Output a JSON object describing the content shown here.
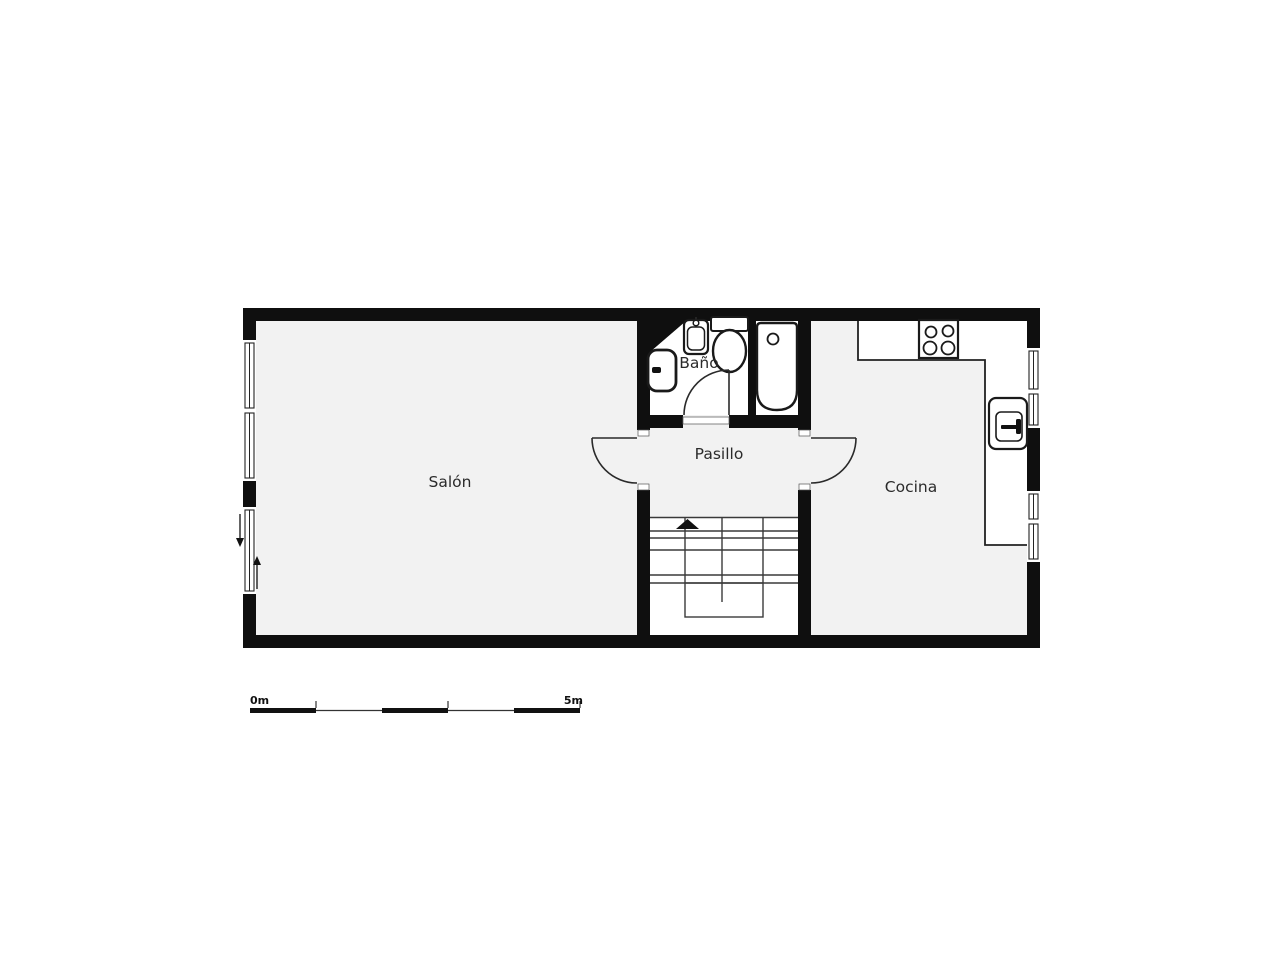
{
  "canvas": {
    "width": 1280,
    "height": 960,
    "background": "#ffffff"
  },
  "floorplan": {
    "type": "apartment-floor-plan",
    "rooms": {
      "salon": {
        "label": "Salón"
      },
      "pasillo": {
        "label": "Pasillo"
      },
      "bano": {
        "label": "Baño"
      },
      "cocina": {
        "label": "Cocina"
      }
    },
    "fixtures": [
      "washbasin-icon",
      "toilet-icon",
      "bathtub-icon",
      "bidet-icon",
      "hob-four-burners-icon",
      "kitchen-sink-icon",
      "kitchen-counter",
      "staircase-with-up-arrow",
      "door-swing-salon",
      "door-swing-cocina",
      "door-swing-bano",
      "window-strips",
      "entry-arrow-down-icon",
      "entry-arrow-up-icon",
      "service-shaft"
    ],
    "colors": {
      "wall": "#0f0f0f",
      "floor": "#f2f2f2",
      "fixture_fill": "#ffffff",
      "fixture_stroke": "#1a1a1a",
      "stair_line": "#3a3a3a",
      "label_text": "#2b2b2b"
    }
  },
  "scale_bar": {
    "start_label": "0m",
    "end_label": "5m",
    "segments_m": 5
  }
}
